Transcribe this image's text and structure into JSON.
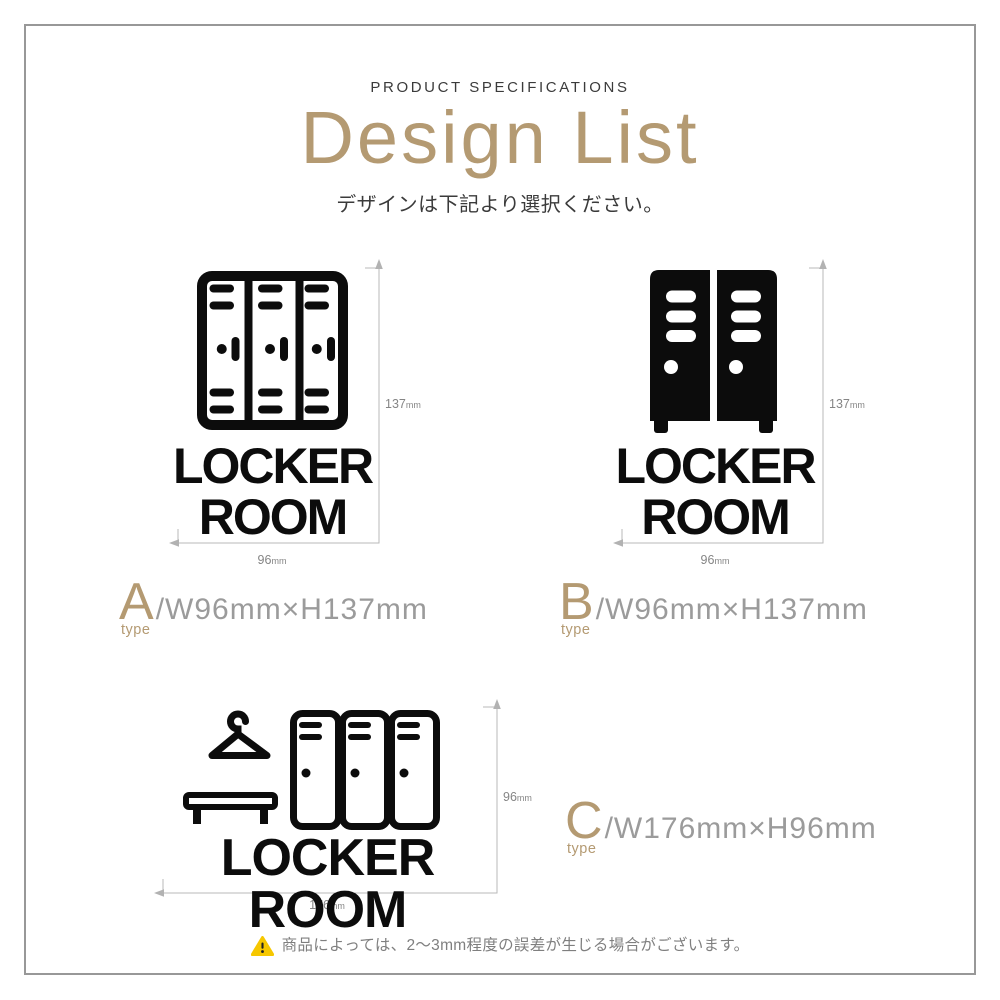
{
  "header": {
    "eyebrow": "PRODUCT SPECIFICATIONS",
    "title": "Design List",
    "subtitle": "デザインは下記より選択ください。"
  },
  "designs": [
    {
      "name": "A",
      "type_letter": "A",
      "type_word": "type",
      "spec": "/W96mm×H137mm",
      "sign_line1": "LOCKER",
      "sign_line2": "ROOM",
      "width_value": "96",
      "height_value": "137",
      "unit": "mm",
      "icon": "locker-3-door-outline-icon"
    },
    {
      "name": "B",
      "type_letter": "B",
      "type_word": "type",
      "spec": "/W96mm×H137mm",
      "sign_line1": "LOCKER",
      "sign_line2": "ROOM",
      "width_value": "96",
      "height_value": "137",
      "unit": "mm",
      "icon": "locker-2-door-solid-icon"
    },
    {
      "name": "C",
      "type_letter": "C",
      "type_word": "type",
      "spec": "/W176mm×H96mm",
      "sign_text": "LOCKER ROOM",
      "width_value": "176",
      "height_value": "96",
      "unit": "mm",
      "icon": "hanger-bench-lockers-outline-icon"
    }
  ],
  "footer": {
    "note": "商品によっては、2〜3mm程度の誤差が生じる場合がございます。"
  },
  "colors": {
    "accent_gold": "#b49a72",
    "ink_black": "#0c0c0c",
    "text_dark": "#3b3b3b",
    "spec_gray": "#9b9b9b",
    "dim_line_gray": "#b9b9b9",
    "dim_label_gray": "#858585",
    "warning_yellow": "#f6c700",
    "frame_gray": "#989898"
  }
}
